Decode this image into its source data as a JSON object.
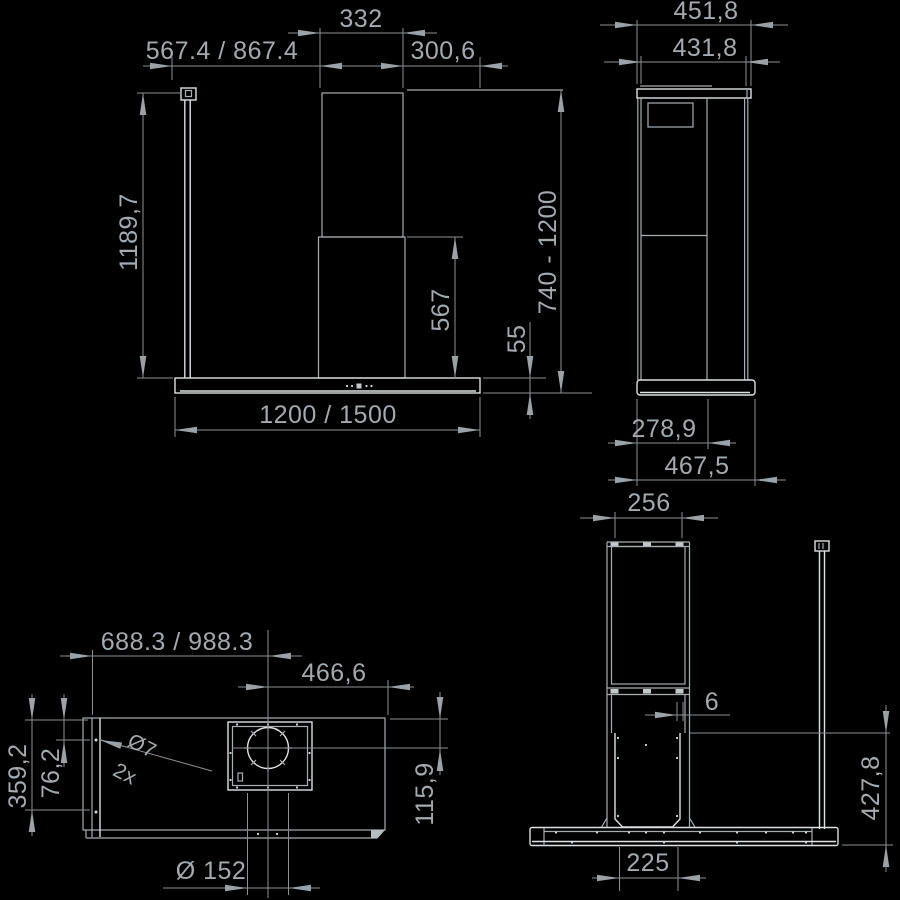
{
  "document": {
    "type": "technical-drawing",
    "subject": "island range hood installation dimensions",
    "background": "#000000",
    "line_color": "#a8aeb1",
    "bright_line_color": "#dde1e3",
    "dimension_color": "#8b9194",
    "text_color": "#a4aaad"
  },
  "views": {
    "front": {
      "dims": {
        "chimney_width": "332",
        "ceiling_offset": "567.4 / 867.4",
        "right_offset": "300,6",
        "pole_height": "1189,7",
        "height_range": "740 - 1200",
        "lower_chimney": "567",
        "body_height": "55",
        "hood_width": "1200 / 1500"
      }
    },
    "side": {
      "dims": {
        "top_depth": "451,8",
        "body_depth": "431,8",
        "chimney_depth": "278,9",
        "base_depth": "467,5"
      }
    },
    "plan": {
      "dims": {
        "duct_offset_left": "688.3 / 988.3",
        "duct_offset_right": "466,6",
        "rear_hole_depth": "359,2",
        "front_hole_depth": "76,2",
        "hole_dia": "Ø7",
        "hole_count": "2x",
        "duct_front_depth": "115,9",
        "duct_dia": "Ø 152"
      }
    },
    "rear": {
      "dims": {
        "chimney_width": "256",
        "panel_gap": "6",
        "mount_height": "427,8",
        "bracket_width": "225"
      }
    }
  }
}
